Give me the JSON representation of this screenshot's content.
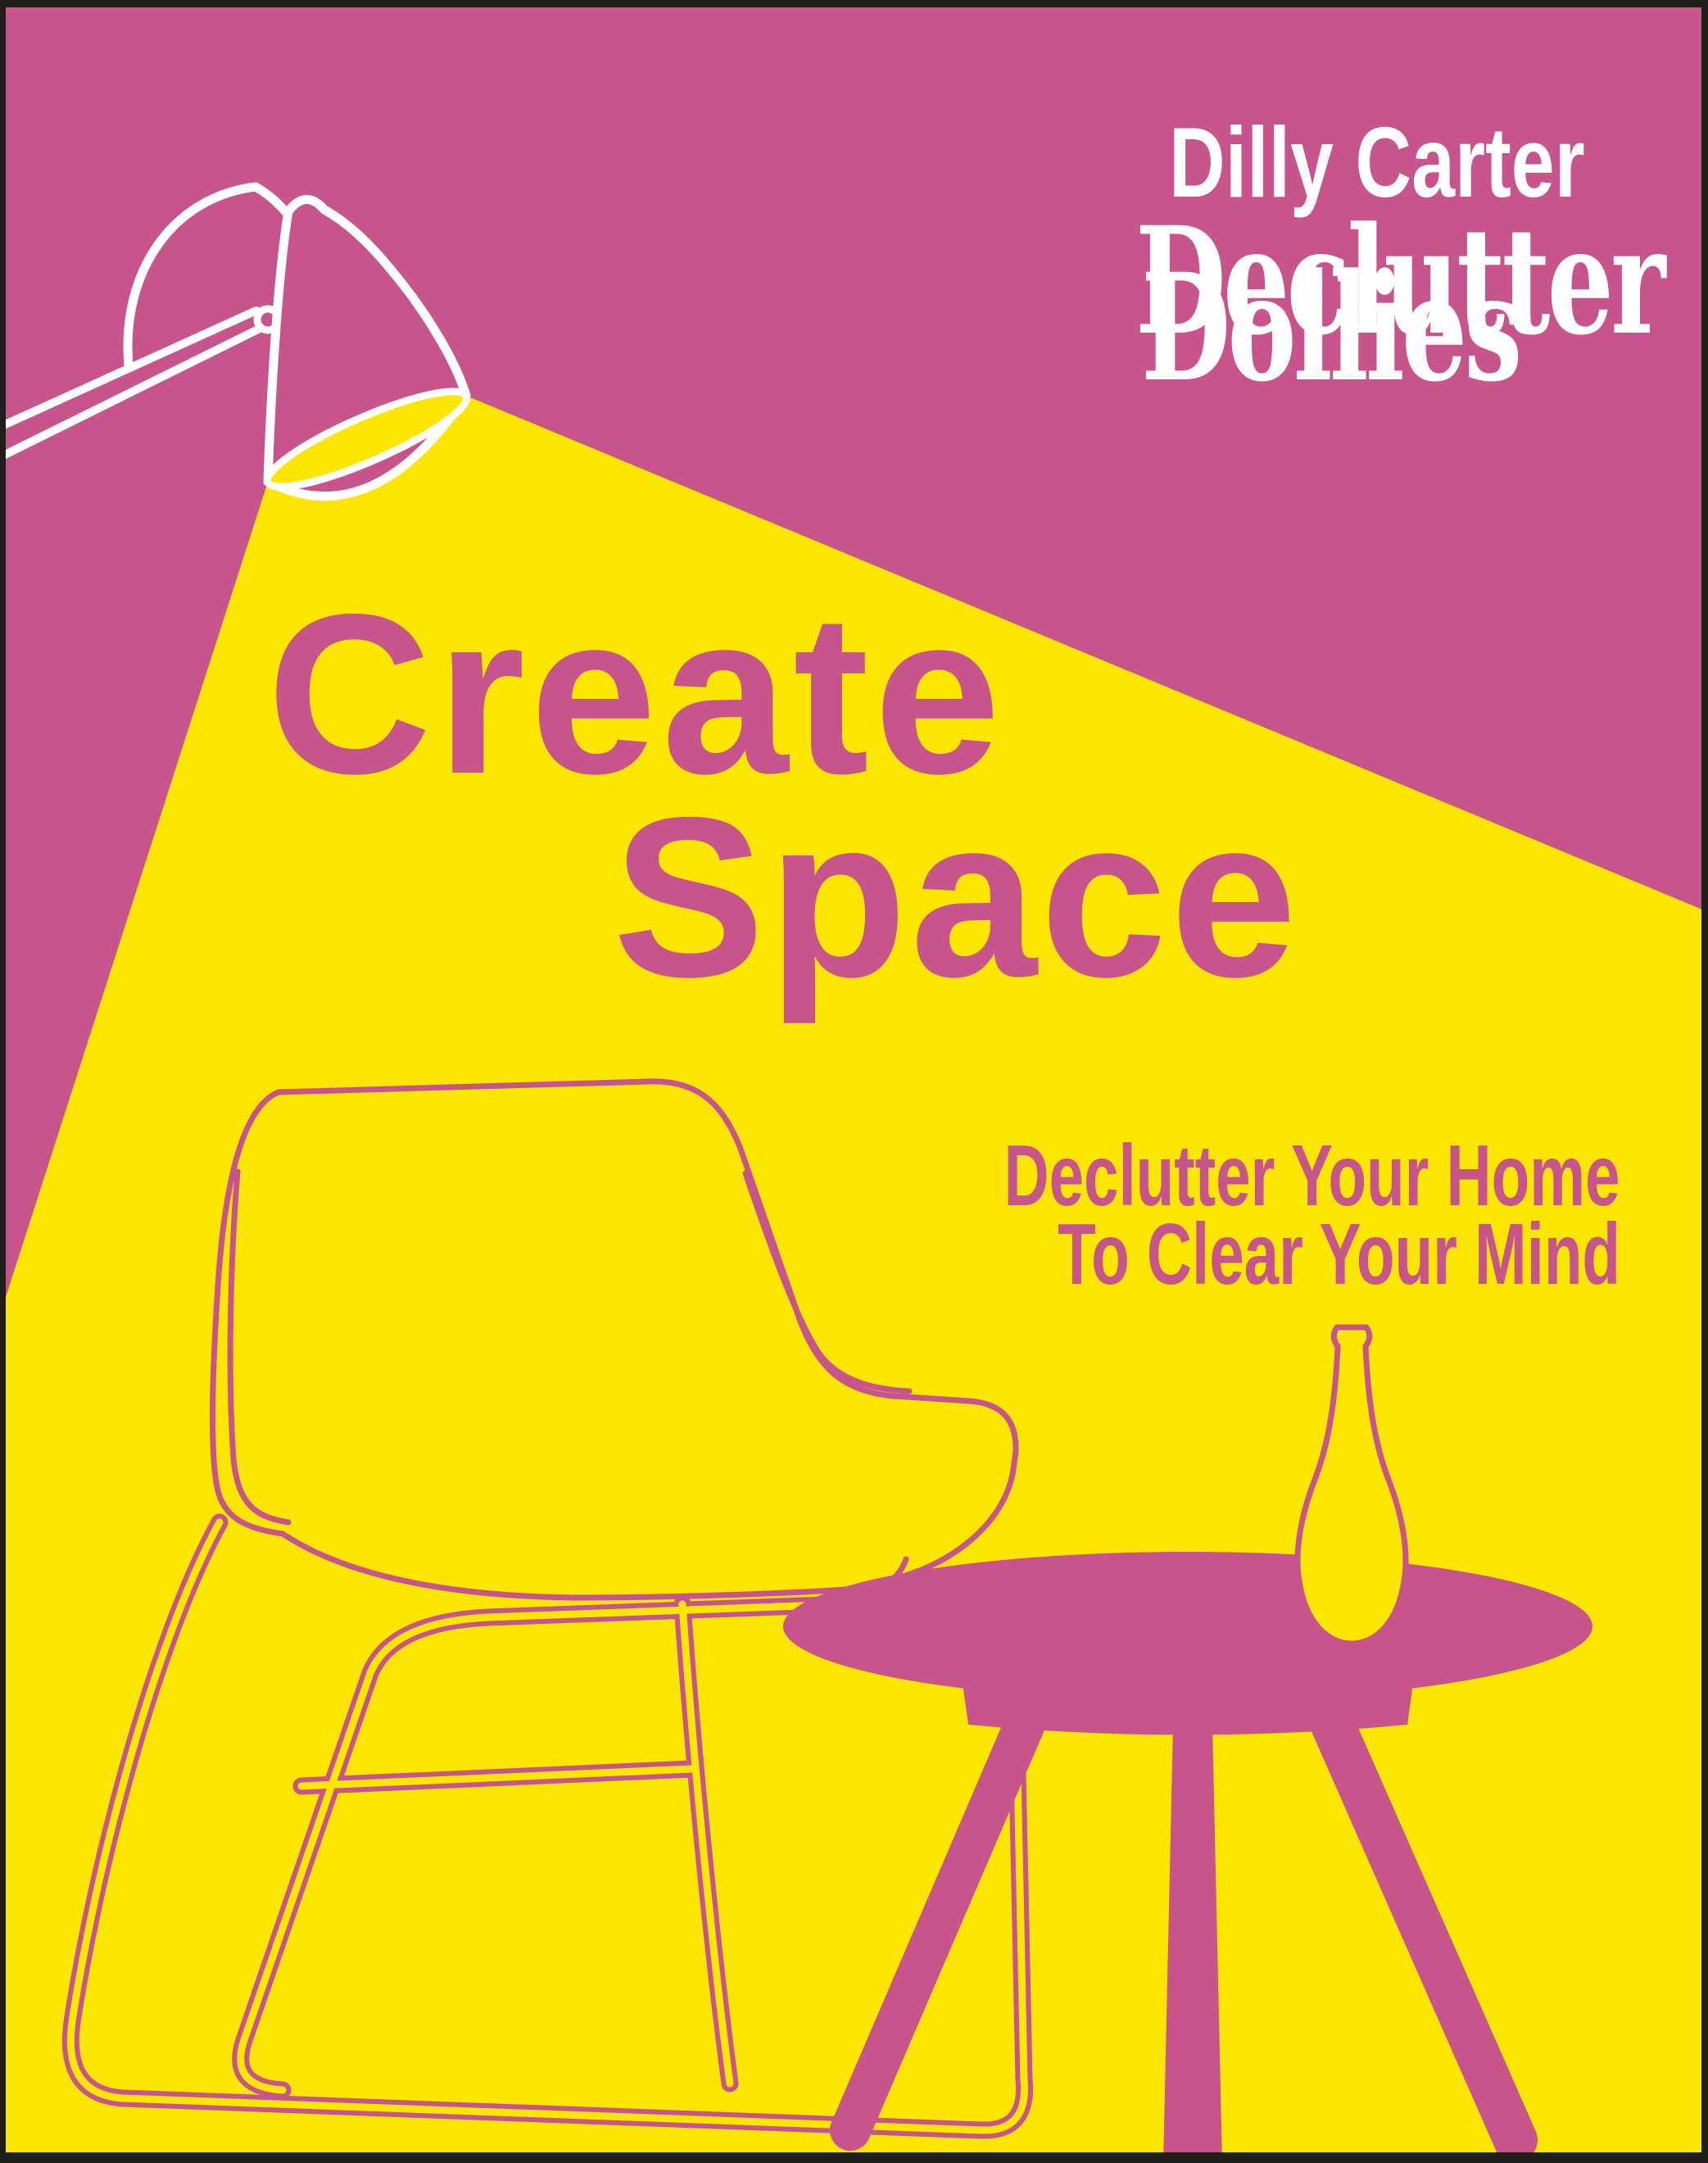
{
  "cover": {
    "author": "Dilly Carter",
    "brand_line1": "Declutter",
    "brand_line2": "Dollies",
    "title_line1": "Create",
    "title_line2": "Space",
    "subtitle_line1": "Declutter Your Home",
    "subtitle_line2": "To Clear Your Mind"
  },
  "colors": {
    "background_pink": "#C8548C",
    "beam_yellow": "#FAE600",
    "text_white": "#FFFFFF",
    "edge_dark": "#1F1E1A"
  }
}
